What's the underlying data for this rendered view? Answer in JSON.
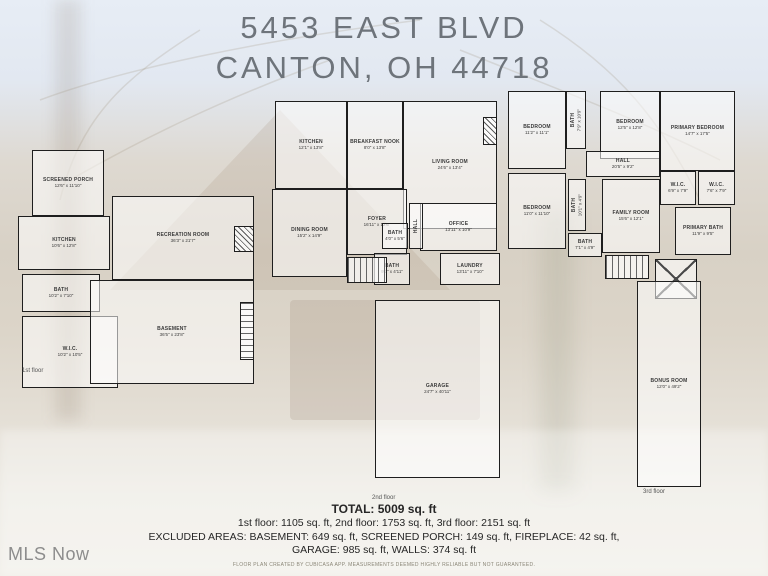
{
  "title": {
    "line1": "5453 EAST BLVD",
    "line2": "CANTON, OH 44718"
  },
  "watermark": "MLS Now",
  "colors": {
    "title_text": "#6e747b",
    "wall": "#1e1e1e",
    "summary_text": "#262626",
    "watermark_text": "#8d8d8d"
  },
  "summary": {
    "total": "TOTAL: 5009 sq. ft",
    "floors_line": "1st floor: 1105 sq. ft, 2nd floor: 1753 sq. ft, 3rd floor: 2151 sq. ft",
    "excluded_line1": "EXCLUDED AREAS: BASEMENT: 649 sq. ft, SCREENED PORCH: 149 sq. ft, FIREPLACE: 42 sq. ft,",
    "excluded_line2": "GARAGE: 985 sq. ft, WALLS: 374 sq. ft",
    "disclaimer": "FLOOR PLAN CREATED BY CUBICASA APP. MEASUREMENTS DEEMED HIGHLY RELIABLE BUT NOT GUARANTEED."
  },
  "floors": [
    {
      "name": "1st floor",
      "name_pos": {
        "x": 14,
        "y": 228
      },
      "pos": {
        "left": 8,
        "top": 140,
        "width": 246,
        "height": 250
      },
      "rooms": [
        {
          "id": "room-screened-porch",
          "label": "SCREENED PORCH",
          "dims": "12'6\" x 11'10\"",
          "x": 24,
          "y": 10,
          "w": 72,
          "h": 66
        },
        {
          "id": "room-kitchen",
          "label": "KITCHEN",
          "dims": "10'6\" x 12'8\"",
          "x": 10,
          "y": 76,
          "w": 92,
          "h": 54
        },
        {
          "id": "room-bath",
          "label": "BATH",
          "dims": "10'2\" x 7'10\"",
          "x": 14,
          "y": 134,
          "w": 78,
          "h": 38
        },
        {
          "id": "room-wic",
          "label": "W.I.C.",
          "dims": "10'2\" x 10'5\"",
          "x": 14,
          "y": 176,
          "w": 96,
          "h": 72
        },
        {
          "id": "room-recreation-room",
          "label": "RECREATION ROOM",
          "dims": "36'3\" x 21'7\"",
          "x": 104,
          "y": 56,
          "w": 142,
          "h": 84
        },
        {
          "id": "room-basement",
          "label": "BASEMENT",
          "dims": "36'5\" x 23'8\"",
          "x": 82,
          "y": 140,
          "w": 164,
          "h": 104
        },
        {
          "id": "fireplace-hatch",
          "type": "hatch",
          "x": 226,
          "y": 86,
          "w": 20,
          "h": 26
        },
        {
          "id": "stairs",
          "type": "stairs-v",
          "x": 232,
          "y": 162,
          "w": 14,
          "h": 58
        }
      ]
    },
    {
      "name": "2nd floor",
      "name_pos": {
        "x": 102,
        "y": 400
      },
      "pos": {
        "left": 270,
        "top": 95,
        "width": 232,
        "height": 398
      },
      "rooms": [
        {
          "id": "room-kitchen",
          "label": "KITCHEN",
          "dims": "12'1\" x 13'8\"",
          "x": 5,
          "y": 6,
          "w": 72,
          "h": 88
        },
        {
          "id": "room-breakfast-nook",
          "label": "BREAKFAST NOOK",
          "dims": "8'0\" x 13'8\"",
          "x": 77,
          "y": 6,
          "w": 56,
          "h": 88
        },
        {
          "id": "room-living-room",
          "label": "LIVING ROOM",
          "dims": "24'6\" x 13'4\"",
          "x": 133,
          "y": 6,
          "w": 94,
          "h": 128
        },
        {
          "id": "room-dining-room",
          "label": "DINING ROOM",
          "dims": "15'2\" x 14'9\"",
          "x": 2,
          "y": 94,
          "w": 75,
          "h": 88
        },
        {
          "id": "room-foyer",
          "label": "FOYER",
          "dims": "16'11\" x 12'6\"",
          "x": 77,
          "y": 94,
          "w": 60,
          "h": 66
        },
        {
          "id": "room-office",
          "label": "OFFICE",
          "dims": "13'11\" x 10'9\"",
          "x": 150,
          "y": 108,
          "w": 77,
          "h": 48
        },
        {
          "id": "room-bath",
          "label": "BATH",
          "dims": "4'0\" x 5'6\"",
          "x": 112,
          "y": 128,
          "w": 26,
          "h": 26
        },
        {
          "id": "room-bath-2",
          "label": "BATH",
          "dims": "9'2\" x 4'11\"",
          "x": 104,
          "y": 158,
          "w": 36,
          "h": 32
        },
        {
          "id": "room-laundry",
          "label": "LAUNDRY",
          "dims": "13'11\" x 7'10\"",
          "x": 170,
          "y": 158,
          "w": 60,
          "h": 32
        },
        {
          "id": "room-hall",
          "label": "HALL",
          "x": 139,
          "y": 108,
          "w": 14,
          "h": 46,
          "vertical": true
        },
        {
          "id": "room-garage",
          "label": "GARAGE",
          "dims": "24'7\" x 40'11\"",
          "x": 105,
          "y": 205,
          "w": 125,
          "h": 178
        },
        {
          "id": "fireplace-hatch",
          "type": "hatch",
          "x": 213,
          "y": 22,
          "w": 14,
          "h": 28
        },
        {
          "id": "stairs",
          "type": "stairs-h",
          "x": 77,
          "y": 162,
          "w": 40,
          "h": 26
        }
      ]
    },
    {
      "name": "3rd floor",
      "name_pos": {
        "x": 138,
        "y": 404
      },
      "pos": {
        "left": 505,
        "top": 85,
        "width": 232,
        "height": 412
      },
      "rooms": [
        {
          "id": "room-bedroom",
          "label": "BEDROOM",
          "dims": "11'2\" x 11'1\"",
          "x": 3,
          "y": 6,
          "w": 58,
          "h": 78
        },
        {
          "id": "room-bath",
          "label": "BATH",
          "dims": "7'9\" x 10'9\"",
          "x": 61,
          "y": 6,
          "w": 20,
          "h": 58,
          "vertical": true
        },
        {
          "id": "room-bedroom-2",
          "label": "BEDROOM",
          "dims": "12'5\" x 12'8\"",
          "x": 95,
          "y": 6,
          "w": 60,
          "h": 68
        },
        {
          "id": "room-primary-bedroom",
          "label": "PRIMARY BEDROOM",
          "dims": "14'7\" x 17'5\"",
          "x": 155,
          "y": 6,
          "w": 75,
          "h": 80
        },
        {
          "id": "room-hall",
          "label": "HALL",
          "dims": "20'5\" x 9'2\"",
          "x": 81,
          "y": 66,
          "w": 74,
          "h": 26
        },
        {
          "id": "room-bedroom-3",
          "label": "BEDROOM",
          "dims": "11'0\" x 11'10\"",
          "x": 3,
          "y": 88,
          "w": 58,
          "h": 76
        },
        {
          "id": "room-bath-2",
          "label": "BATH",
          "dims": "10'1\" x 4'9\"",
          "x": 63,
          "y": 94,
          "w": 18,
          "h": 52,
          "vertical": true
        },
        {
          "id": "room-bath-3",
          "label": "BATH",
          "dims": "7'1\" x 4'9\"",
          "x": 63,
          "y": 148,
          "w": 34,
          "h": 24
        },
        {
          "id": "room-family-room",
          "label": "FAMILY ROOM",
          "dims": "15'6\" x 12'1\"",
          "x": 97,
          "y": 94,
          "w": 58,
          "h": 74
        },
        {
          "id": "room-wic",
          "label": "W.I.C.",
          "dims": "6'9\" x 7'9\"",
          "x": 155,
          "y": 86,
          "w": 36,
          "h": 34
        },
        {
          "id": "room-wic-2",
          "label": "W.I.C.",
          "dims": "7'6\" x 7'9\"",
          "x": 193,
          "y": 86,
          "w": 37,
          "h": 34
        },
        {
          "id": "room-primary-bath",
          "label": "PRIMARY BATH",
          "dims": "11'9\" x 9'5\"",
          "x": 170,
          "y": 122,
          "w": 56,
          "h": 48
        },
        {
          "id": "chimney-xbox",
          "type": "xbox",
          "x": 150,
          "y": 174,
          "w": 42,
          "h": 40
        },
        {
          "id": "stairs",
          "type": "stairs-h",
          "x": 100,
          "y": 170,
          "w": 44,
          "h": 24
        },
        {
          "id": "room-bonus-room",
          "label": "BONUS ROOM",
          "dims": "12'0\" x 49'2\"",
          "x": 132,
          "y": 196,
          "w": 64,
          "h": 206
        }
      ]
    }
  ]
}
